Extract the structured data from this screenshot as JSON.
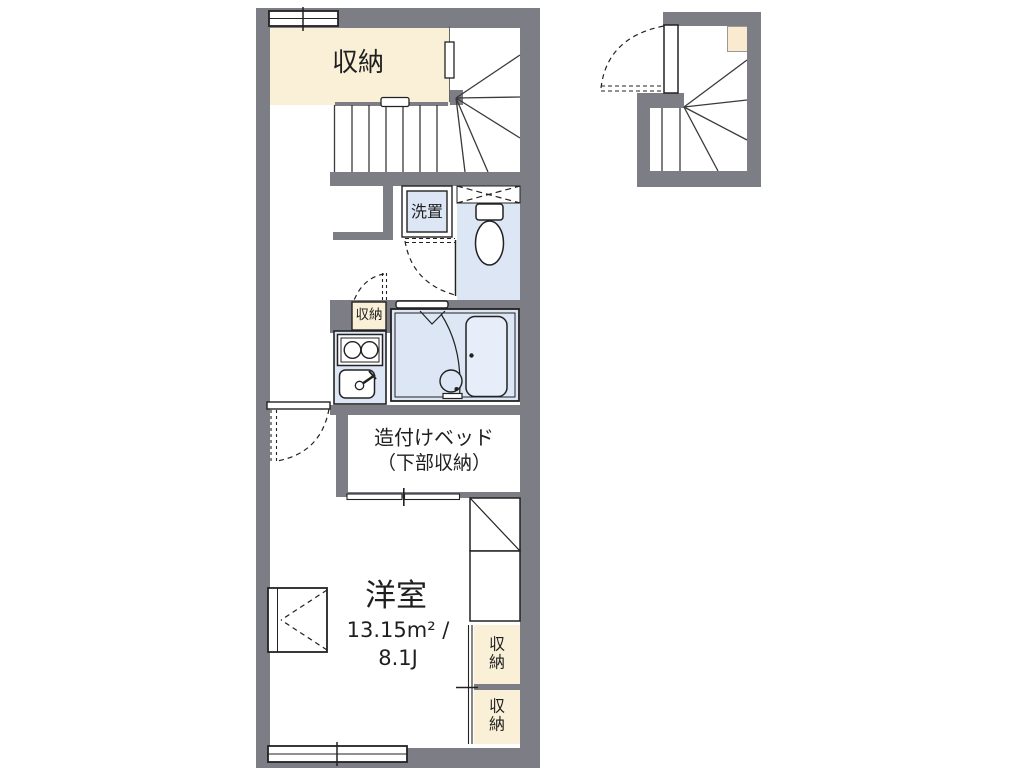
{
  "plan": {
    "unit": {
      "closet_top_label": "収納",
      "washer_label": "洗置",
      "closet_small_label": "収納",
      "bed_label_line1": "造付けベッド",
      "bed_label_line2": "（下部収納）",
      "main_room_name": "洋室",
      "main_room_area_m2": "13.15m² /",
      "main_room_area_jo": "8.1J",
      "storage_right_top_label": "収納",
      "storage_right_bottom_label": "収納"
    },
    "colors": {
      "wall": "#7d7d85",
      "closet_fill": "#faf0d8",
      "wet_area_fill": "#dce6f4",
      "bathtub_fill": "#e7eef9",
      "line": "#222222"
    }
  }
}
